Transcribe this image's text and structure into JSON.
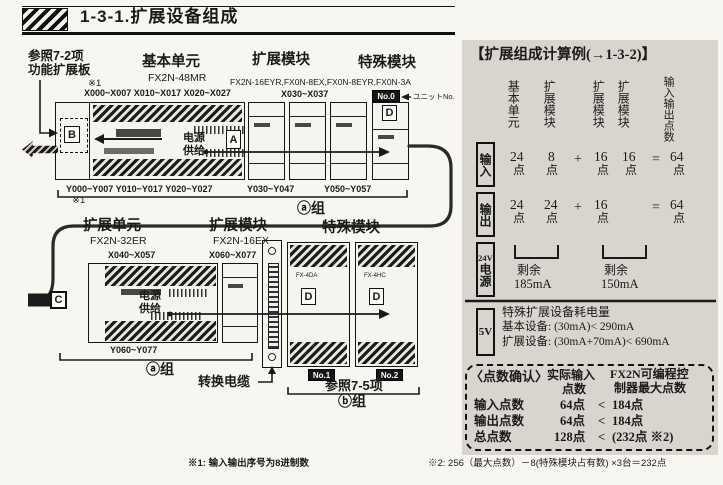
{
  "page": {
    "title": "1-3-1.扩展设备组成",
    "footnote_left": "※1: 输入输出序号为8进制数",
    "footnote_right": "※2: 256（最大点数）－8(特殊模块占有数) ×3台＝232点"
  },
  "diagram": {
    "row1": {
      "fn_board_ref": "参照7-2项",
      "fn_board_name": "功能扩展板",
      "fn_board_note": "※1",
      "base_title": "基本单元",
      "base_model": "FX2N-48MR",
      "exp_title": "扩展模块",
      "special_title": "特殊模块",
      "models_line": "FX2N-16EYR,FX0N-8EX,FX0N-8EYR,FX0N-3A",
      "x_base": "X000~X007 X010~X017 X020~X027",
      "x_mod": "X030~X037",
      "unit_no": "No.0",
      "unit_no_note": "ユニットNo.",
      "power_line1": "电源",
      "power_line2": "供给",
      "tag_a": "A",
      "tag_b": "B",
      "tag_d": "D",
      "y_base": "Y000~Y007 Y010~Y017 Y020~Y027",
      "y_note": "※1",
      "y_mod1": "Y030~Y047",
      "y_mod2": "Y050~Y057",
      "group_label": "ⓐ组"
    },
    "row2": {
      "ext_title": "扩展单元",
      "ext_model": "FX2N-32ER",
      "exp_title": "扩展模块",
      "exp_model": "FX2N-16EX",
      "special_title": "特殊模块",
      "x_unit": "X040~X057",
      "x_mod": "X060~X077",
      "y_unit": "Y060~Y077",
      "power_line1": "电源",
      "power_line2": "供给",
      "tag_c": "C",
      "tag_d1": "D",
      "tag_d2": "D",
      "sp1_model": "FX-4DA",
      "sp2_model": "FX-4HC",
      "no1": "No.1",
      "no2": "No.2",
      "cable_label": "转换电缆",
      "ref_label": "参照7-5项",
      "group_a_label": "ⓐ组",
      "group_b_label": "ⓑ组"
    }
  },
  "panel": {
    "title": "【扩展组成计算例(→1-3-2)】",
    "col_headers": [
      "基本单元",
      "扩展模块",
      "扩展模块",
      "扩展模块",
      "输入输出点数"
    ],
    "unit": "点",
    "plus": "+",
    "equals": "=",
    "input_label": "输入",
    "input_nums": [
      "24",
      "8",
      "16",
      "16",
      "64"
    ],
    "output_label": "输出",
    "output_nums": [
      "24",
      "24",
      "16",
      "64"
    ],
    "p24": {
      "label_top": "24V",
      "label_v": "电源",
      "left_note1": "剩余",
      "left_note2": "185mA",
      "right_note1": "剩余",
      "right_note2": "150mA"
    },
    "p5": {
      "label": "5V",
      "line1": "特殊扩展设备耗电量",
      "line2": "基本设备: (30mA)< 290mA",
      "line3": "扩展设备: (30mA+70mA)< 690mA"
    },
    "check": {
      "title": "〈点数确认〉",
      "col1_line1": "实际输入",
      "col1_line2": "点数",
      "col2_line1": "FX2N可编程控",
      "col2_line2": "制器最大点数",
      "rows": [
        {
          "name": "输入点数",
          "actual": "64点",
          "lt": "<",
          "max": "184点"
        },
        {
          "name": "输出点数",
          "actual": "64点",
          "lt": "<",
          "max": "184点"
        },
        {
          "name": "总点数",
          "actual": "128点",
          "lt": "<",
          "max": "(232点 ※2)"
        }
      ]
    }
  }
}
